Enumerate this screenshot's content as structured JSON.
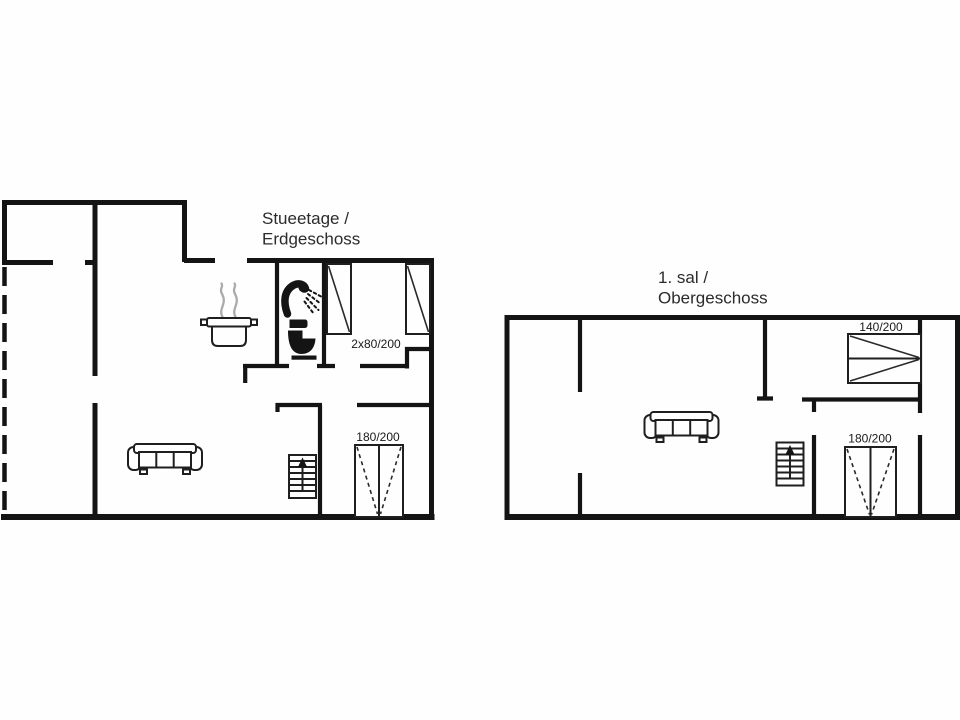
{
  "document": {
    "kind": "holiday-house floor plan",
    "background_color": "#fefefe",
    "wall_color": "#141414",
    "text_color": "#2b2b2b"
  },
  "floors": [
    {
      "name": "ground-floor",
      "title_lines": [
        "Stueetage /",
        "Erdgeschoss"
      ],
      "beds": [
        {
          "label": "2x80/200"
        },
        {
          "label": "180/200"
        }
      ],
      "icons": [
        "cooking-pot-icon",
        "steam-icon",
        "hand-shower-icon",
        "toilet-icon",
        "sofa-icon",
        "stairs-up-icon",
        "single-bed-icon",
        "double-bed-icon"
      ]
    },
    {
      "name": "upper-floor",
      "title_lines": [
        "1. sal /",
        "Obergeschoss"
      ],
      "beds": [
        {
          "label": "140/200"
        },
        {
          "label": "180/200"
        }
      ],
      "icons": [
        "sofa-icon",
        "stairs-up-icon",
        "double-bed-icon"
      ]
    }
  ]
}
